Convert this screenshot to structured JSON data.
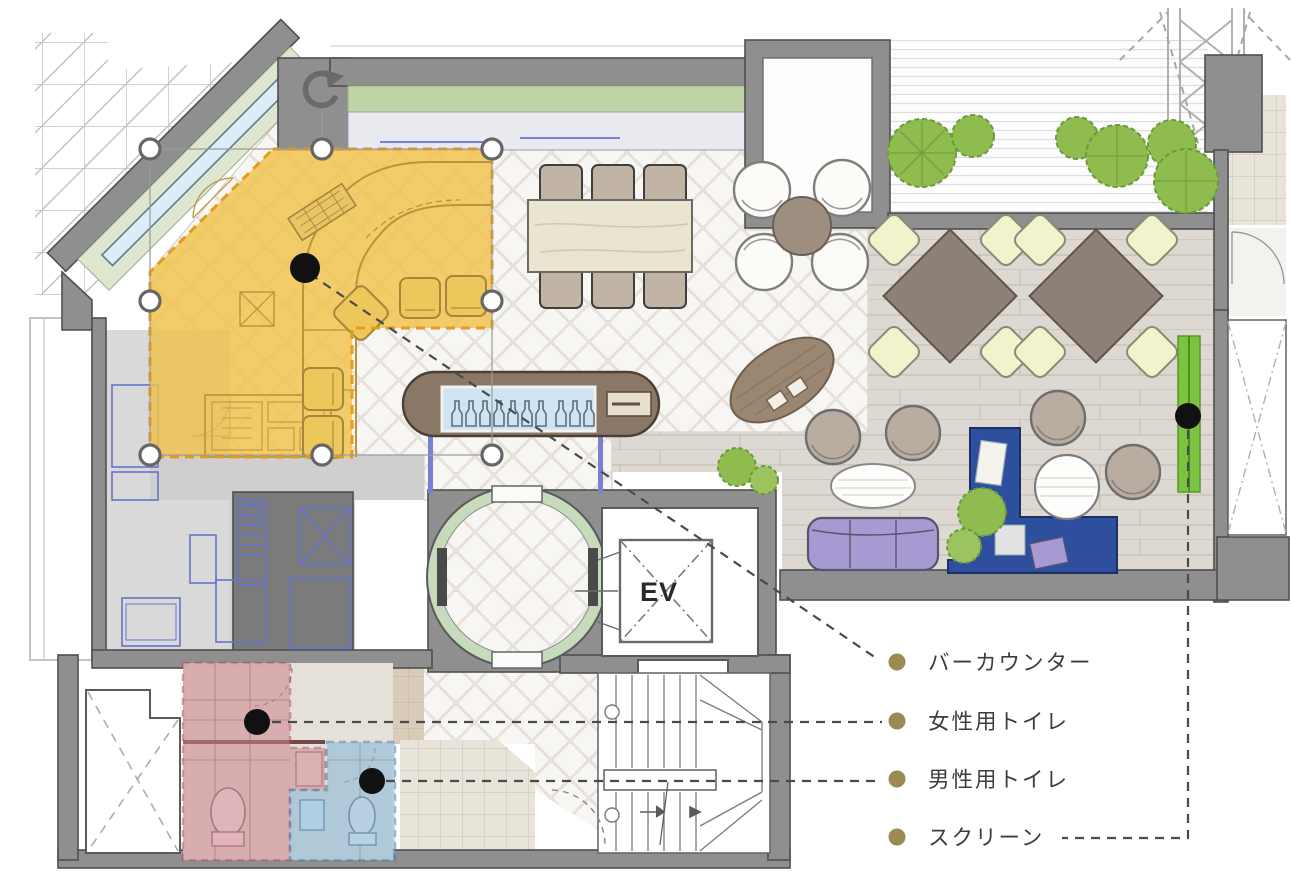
{
  "plan": {
    "elevator_label": "EV",
    "legend": {
      "bullet_color": "#9c8a55",
      "text_color": "#3d3d3d",
      "items": [
        {
          "id": "bar-counter",
          "label": "バーカウンター"
        },
        {
          "id": "womens-toilet",
          "label": "女性用トイレ"
        },
        {
          "id": "mens-toilet",
          "label": "男性用トイレ"
        },
        {
          "id": "screen",
          "label": "スクリーン"
        }
      ]
    },
    "highlights": {
      "bar_counter": {
        "fill": "#f0c24b",
        "border": "#e39c1c"
      },
      "womens_toilet": {
        "fill": "#cd8490",
        "border": "#b04a5a"
      },
      "mens_toilet": {
        "fill": "#85b7d9",
        "border": "#3f7fae"
      },
      "screen": {
        "fill": "#7cc342"
      }
    },
    "marker_color": "#111111",
    "wall_color": "#8f8f8f",
    "selection": {
      "handle_fill": "#ffffff",
      "handle_stroke": "#666666"
    }
  }
}
